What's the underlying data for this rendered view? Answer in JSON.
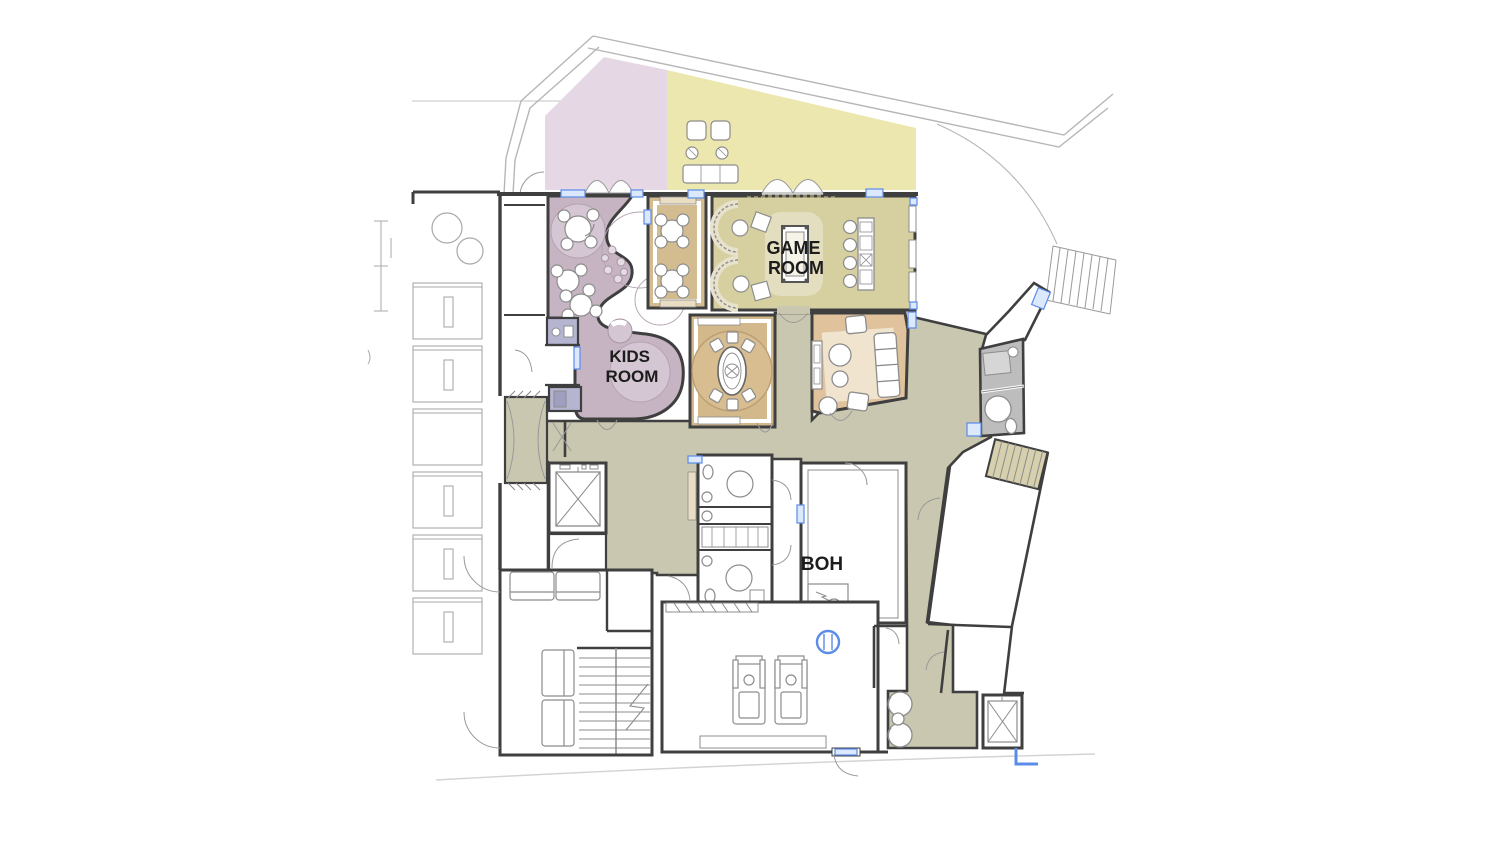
{
  "labels": {
    "game_room_line1": "GAME",
    "game_room_line2": "ROOM",
    "kids_room_line1": "KIDS",
    "kids_room_line2": "ROOM",
    "boh": "BOH"
  },
  "colors": {
    "terrace_pink": "#e6d7e5",
    "terrace_yellow": "#ece7ae",
    "game_room": "#d6d0a0",
    "game_rug": "#e3debf",
    "cafe_tan": "#d3bd90",
    "activity_tan": "#d2b88b",
    "activity_rug": "#d7bd90",
    "lounge_orange": "#e0c39c",
    "lounge_rug": "#f1e4cf",
    "kids_purple": "#c6b4c3",
    "kids_light": "#d4c6d2",
    "closet_lavender": "#b5b5d1",
    "corridor_olive": "#c9c7b0",
    "stair_tan": "#d7d0ae",
    "bathroom_gray": "#bdbdbd",
    "bench_beige": "#e9ddc3",
    "wall_dark": "#3f3f3f",
    "site_gray": "#b6b6b6",
    "furniture_gray": "#8c8c8c",
    "window_blue_fill": "#dce8fb",
    "window_blue_stroke": "#5b8cea",
    "text": "#1c1c1c",
    "white": "#ffffff"
  }
}
